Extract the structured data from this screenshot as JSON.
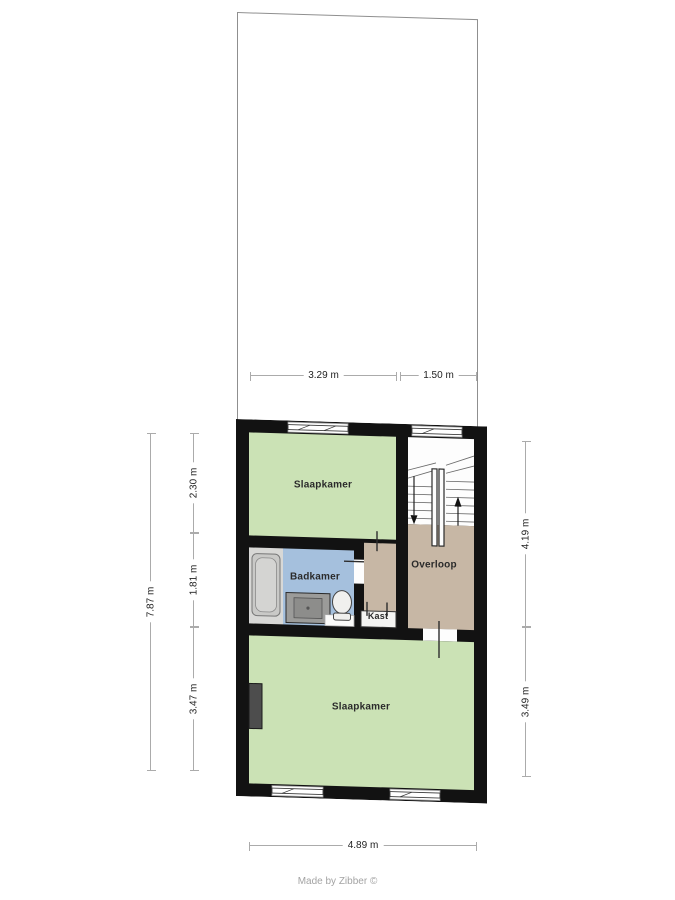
{
  "plan": {
    "floor_type": "upper-floor-plan",
    "rooms": {
      "bedroom_top": "Slaapkamer",
      "bathroom": "Badkamer",
      "landing": "Overloop",
      "closet": "Kast",
      "bedroom_bottom": "Slaapkamer"
    },
    "dimensions": {
      "top_width_left": "3.29 m",
      "top_width_right": "1.50 m",
      "left_total_height": "7.87 m",
      "left_segment_top": "2.30 m",
      "left_segment_middle": "1.81 m",
      "left_segment_bottom": "3.47 m",
      "right_segment_top": "4.19 m",
      "right_segment_bottom": "3.49 m",
      "bottom_width": "4.89 m"
    }
  },
  "footer": {
    "credit": "Made by Zibber ©"
  },
  "colors": {
    "bedroom_fill": "#cbe2b5",
    "bathroom_fill": "#a5c0dd",
    "landing_fill": "#c7b7a5",
    "wall_fill": "#121212",
    "closet_floor": "#f4f4f2",
    "tub_area": "#d8d8d6",
    "stairs_floor": "#fdfdfd",
    "dim_line": "#ababab",
    "dim_text": "#222222",
    "credit_text": "#a3a3a3",
    "outline": "#8f8f8f"
  }
}
